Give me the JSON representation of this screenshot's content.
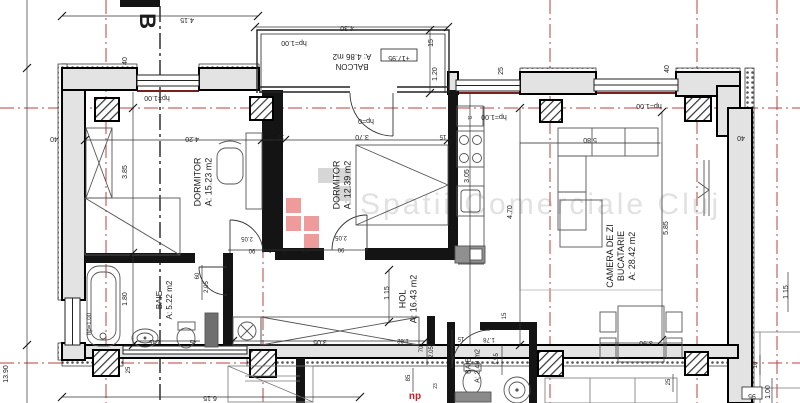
{
  "watermark": {
    "text": "Spatii Comerciale Cluj"
  },
  "section_marker": "B",
  "level_box": "+17.95",
  "elevation_box": "95",
  "red_note": "np",
  "rooms": [
    {
      "id": "dormitor-1",
      "lines": [
        "DORMITOR",
        "A: 15.23 m2"
      ],
      "x": 206,
      "y": 182,
      "r": -90,
      "s": 9
    },
    {
      "id": "dormitor-2",
      "lines": [
        "DORMITOR",
        "A: 12.39 m2"
      ],
      "x": 345,
      "y": 185,
      "r": -90,
      "s": 9
    },
    {
      "id": "camera-de-zi",
      "lines": [
        "CAMERA DE ZI",
        "BUCATARIE",
        "A: 28.42 m2"
      ],
      "x": 624,
      "y": 256,
      "r": -90,
      "s": 9
    },
    {
      "id": "hol",
      "lines": [
        "HOL",
        "A: 16.43 m2"
      ],
      "x": 411,
      "y": 299,
      "r": -90,
      "s": 9
    },
    {
      "id": "baie-1",
      "lines": [
        "BAIE",
        "A: 5.22 m2"
      ],
      "x": 167,
      "y": 300,
      "r": -90,
      "s": 8
    },
    {
      "id": "baie-2",
      "lines": [
        "BAIE",
        "A: 2.49 m2"
      ],
      "x": 475,
      "y": 366,
      "r": -90,
      "s": 7
    },
    {
      "id": "balcon",
      "lines": [
        "BALCON",
        "A: 4.86 m2"
      ],
      "x": 352,
      "y": 59,
      "r": 180,
      "s": 8
    }
  ],
  "labels": [
    {
      "t": "4.15",
      "x": 187,
      "y": 18,
      "r": 180
    },
    {
      "t": "4.30",
      "x": 347,
      "y": 26,
      "r": 180
    },
    {
      "t": "40",
      "x": 127,
      "y": 61,
      "r": -90
    },
    {
      "t": "25",
      "x": 503,
      "y": 71,
      "r": -90
    },
    {
      "t": "40",
      "x": 669,
      "y": 69,
      "r": -90
    },
    {
      "t": "15",
      "x": 433,
      "y": 43,
      "r": -90
    },
    {
      "t": "1.20",
      "x": 437,
      "y": 74,
      "r": -90
    },
    {
      "t": "40",
      "x": 54,
      "y": 137,
      "r": 180
    },
    {
      "t": "4.20",
      "x": 192,
      "y": 137,
      "r": 180
    },
    {
      "t": "15",
      "x": 281,
      "y": 135,
      "r": 180,
      "s": 6
    },
    {
      "t": "3.70",
      "x": 362,
      "y": 135,
      "r": 180
    },
    {
      "t": "15",
      "x": 443,
      "y": 135,
      "r": 180,
      "s": 6
    },
    {
      "t": "5.80",
      "x": 590,
      "y": 138,
      "r": 180
    },
    {
      "t": "40",
      "x": 741,
      "y": 136,
      "r": 180
    },
    {
      "t": "3.85",
      "x": 127,
      "y": 172,
      "r": -90
    },
    {
      "t": "4.70",
      "x": 512,
      "y": 212,
      "r": -90
    },
    {
      "t": "5.85",
      "x": 668,
      "y": 228,
      "r": -90
    },
    {
      "t": "3.05",
      "x": 469,
      "y": 176,
      "r": -90
    },
    {
      "t": "2.05",
      "x": 247,
      "y": 237,
      "r": 180,
      "s": 6
    },
    {
      "t": "90",
      "x": 252,
      "y": 249,
      "r": 180,
      "s": 6
    },
    {
      "t": "5",
      "x": 270,
      "y": 249,
      "r": 180,
      "s": 5
    },
    {
      "t": "15",
      "x": 285,
      "y": 249,
      "r": 180,
      "s": 6
    },
    {
      "t": "91",
      "x": 305,
      "y": 249,
      "r": 180,
      "s": 6
    },
    {
      "t": "2.05",
      "x": 341,
      "y": 236,
      "r": 180,
      "s": 6
    },
    {
      "t": "90",
      "x": 341,
      "y": 248,
      "r": 180,
      "s": 6
    },
    {
      "t": "60",
      "x": 199,
      "y": 276,
      "r": -90,
      "s": 6
    },
    {
      "t": "2.05",
      "x": 208,
      "y": 287,
      "r": -90,
      "s": 6
    },
    {
      "t": "1.80",
      "x": 127,
      "y": 299,
      "r": -90
    },
    {
      "t": "1.15",
      "x": 389,
      "y": 293,
      "r": -90
    },
    {
      "t": "1.15",
      "x": 788,
      "y": 292,
      "r": -90
    },
    {
      "t": "13.90",
      "x": 8,
      "y": 374,
      "r": -90
    },
    {
      "t": "25",
      "x": 130,
      "y": 370,
      "r": -90,
      "s": 6
    },
    {
      "t": "2.45",
      "x": 155,
      "y": 340,
      "r": 180,
      "s": 6
    },
    {
      "t": "45",
      "x": 193,
      "y": 340,
      "r": 180,
      "s": 6
    },
    {
      "t": "3.05",
      "x": 320,
      "y": 340,
      "r": 180
    },
    {
      "t": "6.15",
      "x": 210,
      "y": 396,
      "r": 180
    },
    {
      "t": "1.62",
      "x": 403,
      "y": 339,
      "r": 180,
      "s": 6
    },
    {
      "t": "70",
      "x": 423,
      "y": 349,
      "r": -90,
      "s": 6
    },
    {
      "t": "2.05",
      "x": 433,
      "y": 352,
      "r": -90,
      "s": 6
    },
    {
      "t": "85",
      "x": 410,
      "y": 378,
      "r": -90,
      "s": 6
    },
    {
      "t": "23",
      "x": 437,
      "y": 386,
      "r": -90,
      "s": 5
    },
    {
      "t": "15",
      "x": 461,
      "y": 337,
      "r": 180,
      "s": 6
    },
    {
      "t": "1.78",
      "x": 489,
      "y": 338,
      "r": 180,
      "s": 6
    },
    {
      "t": "1.55",
      "x": 498,
      "y": 359,
      "r": -90,
      "s": 6
    },
    {
      "t": "15",
      "x": 506,
      "y": 316,
      "r": -90,
      "s": 6
    },
    {
      "t": "3.90",
      "x": 646,
      "y": 341,
      "r": 180
    },
    {
      "t": "25",
      "x": 670,
      "y": 382,
      "r": -90,
      "s": 6
    },
    {
      "t": "10",
      "x": 757,
      "y": 365,
      "r": -90,
      "s": 6
    },
    {
      "t": "1.00",
      "x": 770,
      "y": 392,
      "r": -90
    },
    {
      "t": "hp=1.00",
      "x": 157,
      "y": 96,
      "r": 180,
      "n": "window-head-label"
    },
    {
      "t": "hp=1.00",
      "x": 294,
      "y": 41,
      "r": 180,
      "n": "window-head-label"
    },
    {
      "t": "hp=1.00",
      "x": 494,
      "y": 115,
      "r": 180,
      "n": "window-head-label"
    },
    {
      "t": "hp=1.00",
      "x": 649,
      "y": 104,
      "r": 180,
      "n": "window-head-label"
    },
    {
      "t": "hp=0",
      "x": 366,
      "y": 119,
      "r": 180,
      "n": "window-head-label"
    },
    {
      "t": "hp=1.00",
      "x": 91,
      "y": 324,
      "r": -90,
      "s": 6,
      "n": "window-head-label"
    },
    {
      "t": "+17.95",
      "x": 399,
      "y": 56,
      "r": 180,
      "n": "level-marker-label"
    },
    {
      "t": "95",
      "x": 752,
      "y": 394,
      "r": 180,
      "n": "elevation-marker-label"
    },
    {
      "t": "ct",
      "x": 470,
      "y": 116,
      "r": 180,
      "s": 5,
      "n": "boiler-label"
    },
    {
      "t": "np",
      "x": 415,
      "y": 399,
      "s": 10,
      "c": "#cc2222",
      "b": 1,
      "n": "red-note-label"
    },
    {
      "t": "B",
      "x": 140,
      "y": 21,
      "r": 90,
      "s": 22,
      "b": 1,
      "n": "section-marker-label"
    }
  ]
}
